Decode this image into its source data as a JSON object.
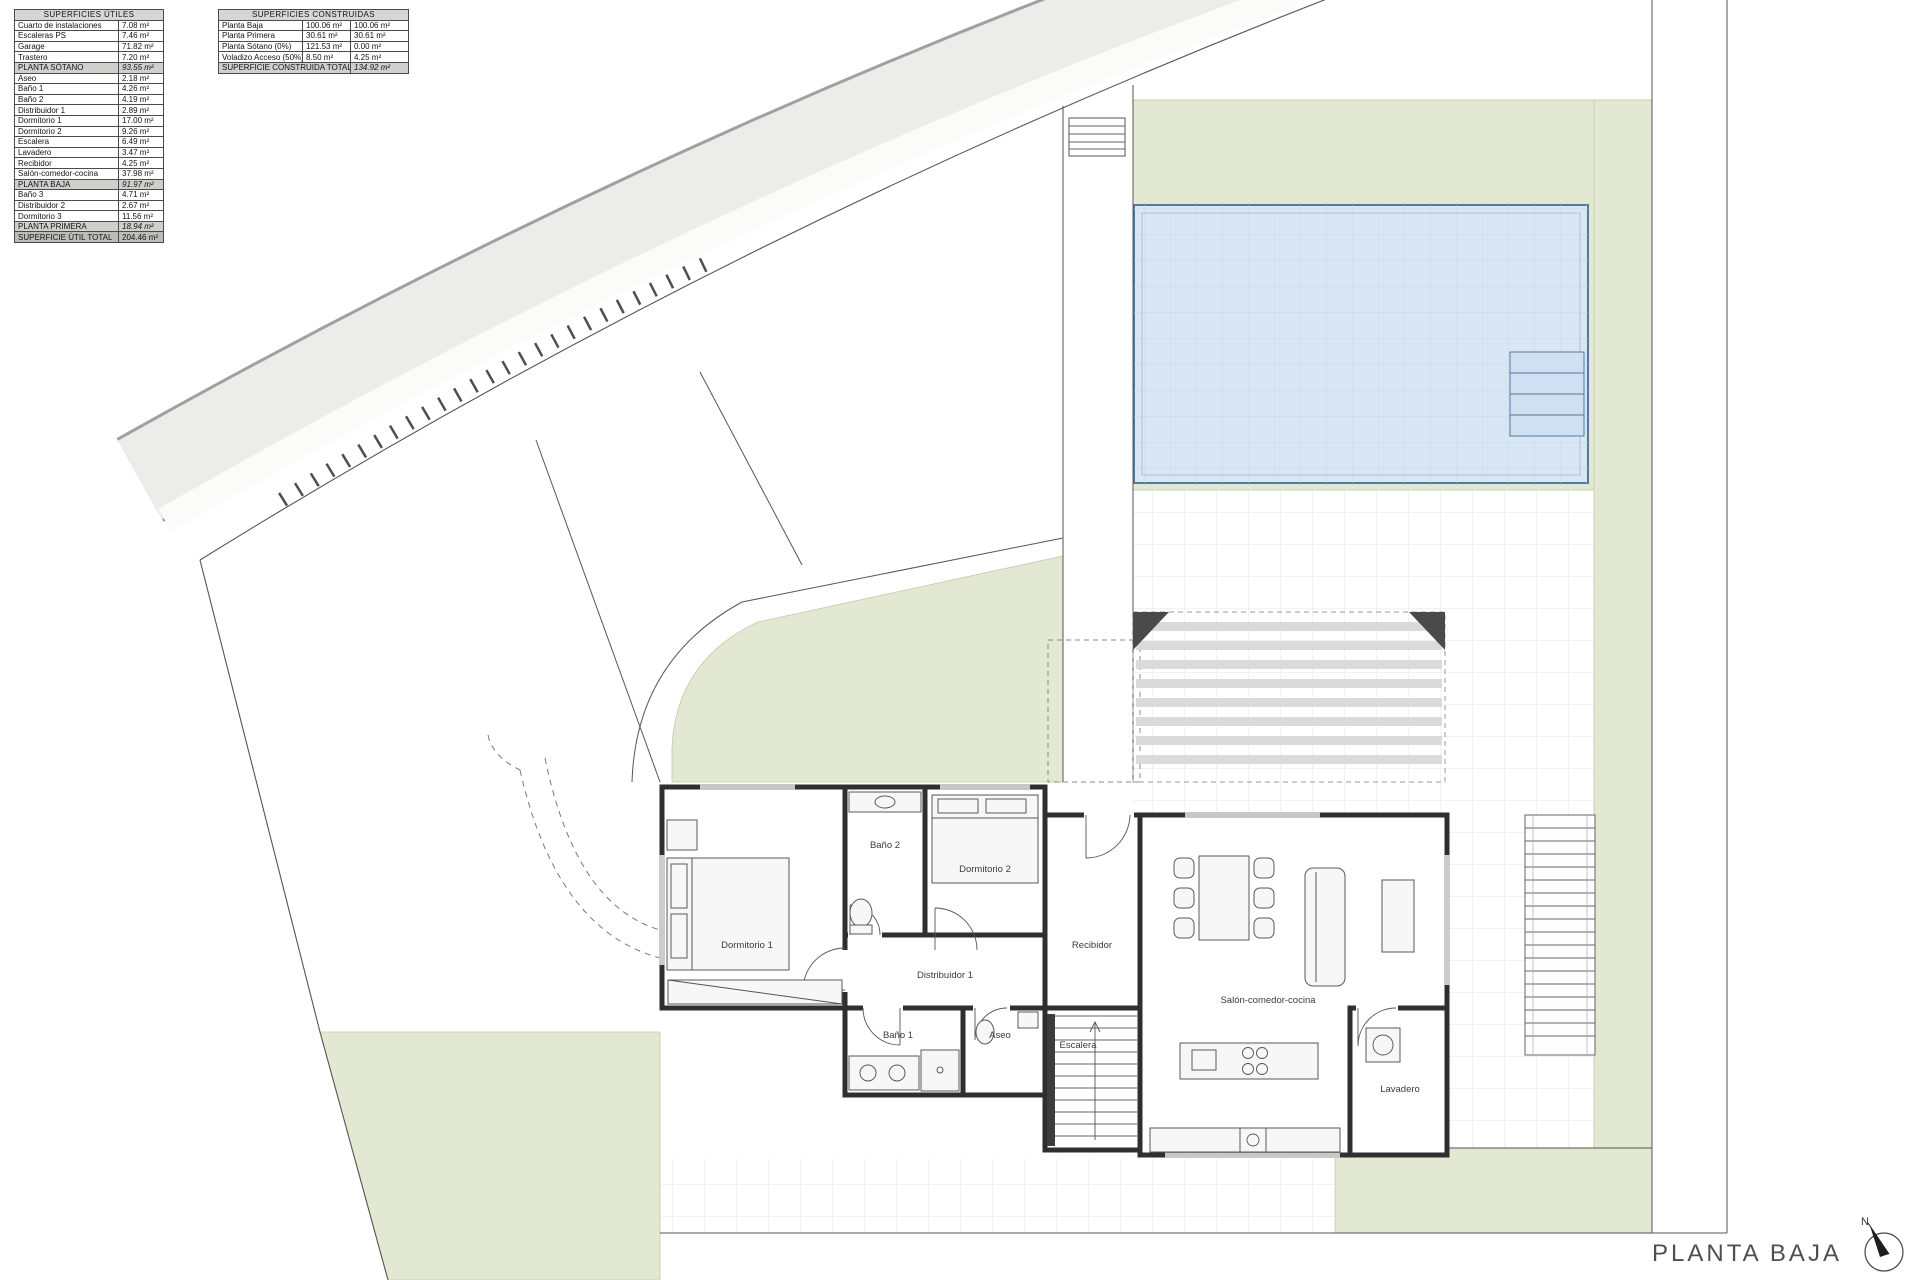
{
  "tables": {
    "utiles": {
      "title": "SUPERFICIES ÚTILES",
      "rows": [
        {
          "label": "Cuarto de instalaciones",
          "value": "7.08 m²"
        },
        {
          "label": "Escaleras PS",
          "value": "7.46 m²"
        },
        {
          "label": "Garage",
          "value": "71.82 m²"
        },
        {
          "label": "Trastero",
          "value": "7.20 m²"
        },
        {
          "label": "PLANTA SÓTANO",
          "value": "93.55 m²"
        },
        {
          "label": "Aseo",
          "value": "2.18 m²"
        },
        {
          "label": "Baño 1",
          "value": "4.26 m²"
        },
        {
          "label": "Baño 2",
          "value": "4.19 m²"
        },
        {
          "label": "Distribuidor 1",
          "value": "2.89 m²"
        },
        {
          "label": "Dormitorio 1",
          "value": "17.00 m²"
        },
        {
          "label": "Dormitorio 2",
          "value": "9.26 m²"
        },
        {
          "label": "Escalera",
          "value": "6.49 m²"
        },
        {
          "label": "Lavadero",
          "value": "3.47 m²"
        },
        {
          "label": "Recibidor",
          "value": "4.25 m²"
        },
        {
          "label": "Salón-comedor-cocina",
          "value": "37.98 m²"
        },
        {
          "label": "PLANTA BAJA",
          "value": "91.97 m²"
        },
        {
          "label": "Baño 3",
          "value": "4.71 m²"
        },
        {
          "label": "Distribuidor 2",
          "value": "2.67 m²"
        },
        {
          "label": "Dormitorio 3",
          "value": "11.56 m²"
        },
        {
          "label": "PLANTA PRIMERA",
          "value": "18.94 m²"
        },
        {
          "label": "SUPERFICIE ÚTIL TOTAL",
          "value": "204.46 m²"
        }
      ]
    },
    "construidas": {
      "title": "SUPERFICIES CONSTRUIDAS",
      "rows": [
        {
          "label": "Planta Baja",
          "built": "100.06 m²",
          "computed": "100.06 m²"
        },
        {
          "label": "Planta Primera",
          "built": "30.61 m²",
          "computed": "30.61 m²"
        },
        {
          "label": "Planta Sótano (0%)",
          "built": "121.53 m²",
          "computed": "0.00 m²"
        },
        {
          "label": "Voladizo Acceso (50%)",
          "built": "8.50 m²",
          "computed": "4.25 m²"
        }
      ],
      "total_label": "SUPERFICIE CONSTRUIDA TOTAL",
      "total_value": "134.92 m²"
    }
  },
  "plan": {
    "labels": {
      "dormitorio1": "Dormitorio 1",
      "bano2": "Baño 2",
      "dormitorio2": "Dormitorio 2",
      "distribuidor1": "Distribuidor 1",
      "recibidor": "Recibidor",
      "bano1": "Baño 1",
      "aseo": "Aseo",
      "escalera": "Escalera",
      "salon": "Salón-comedor-cocina",
      "lavadero": "Lavadero"
    },
    "title": "PLANTA BAJA",
    "north": "N"
  },
  "colors": {
    "green": "#e2e8d2",
    "pool_fill": "#d9e6f4",
    "pool_border": "#54799e",
    "wall": "#2f2f2f",
    "road": "#ececea"
  }
}
